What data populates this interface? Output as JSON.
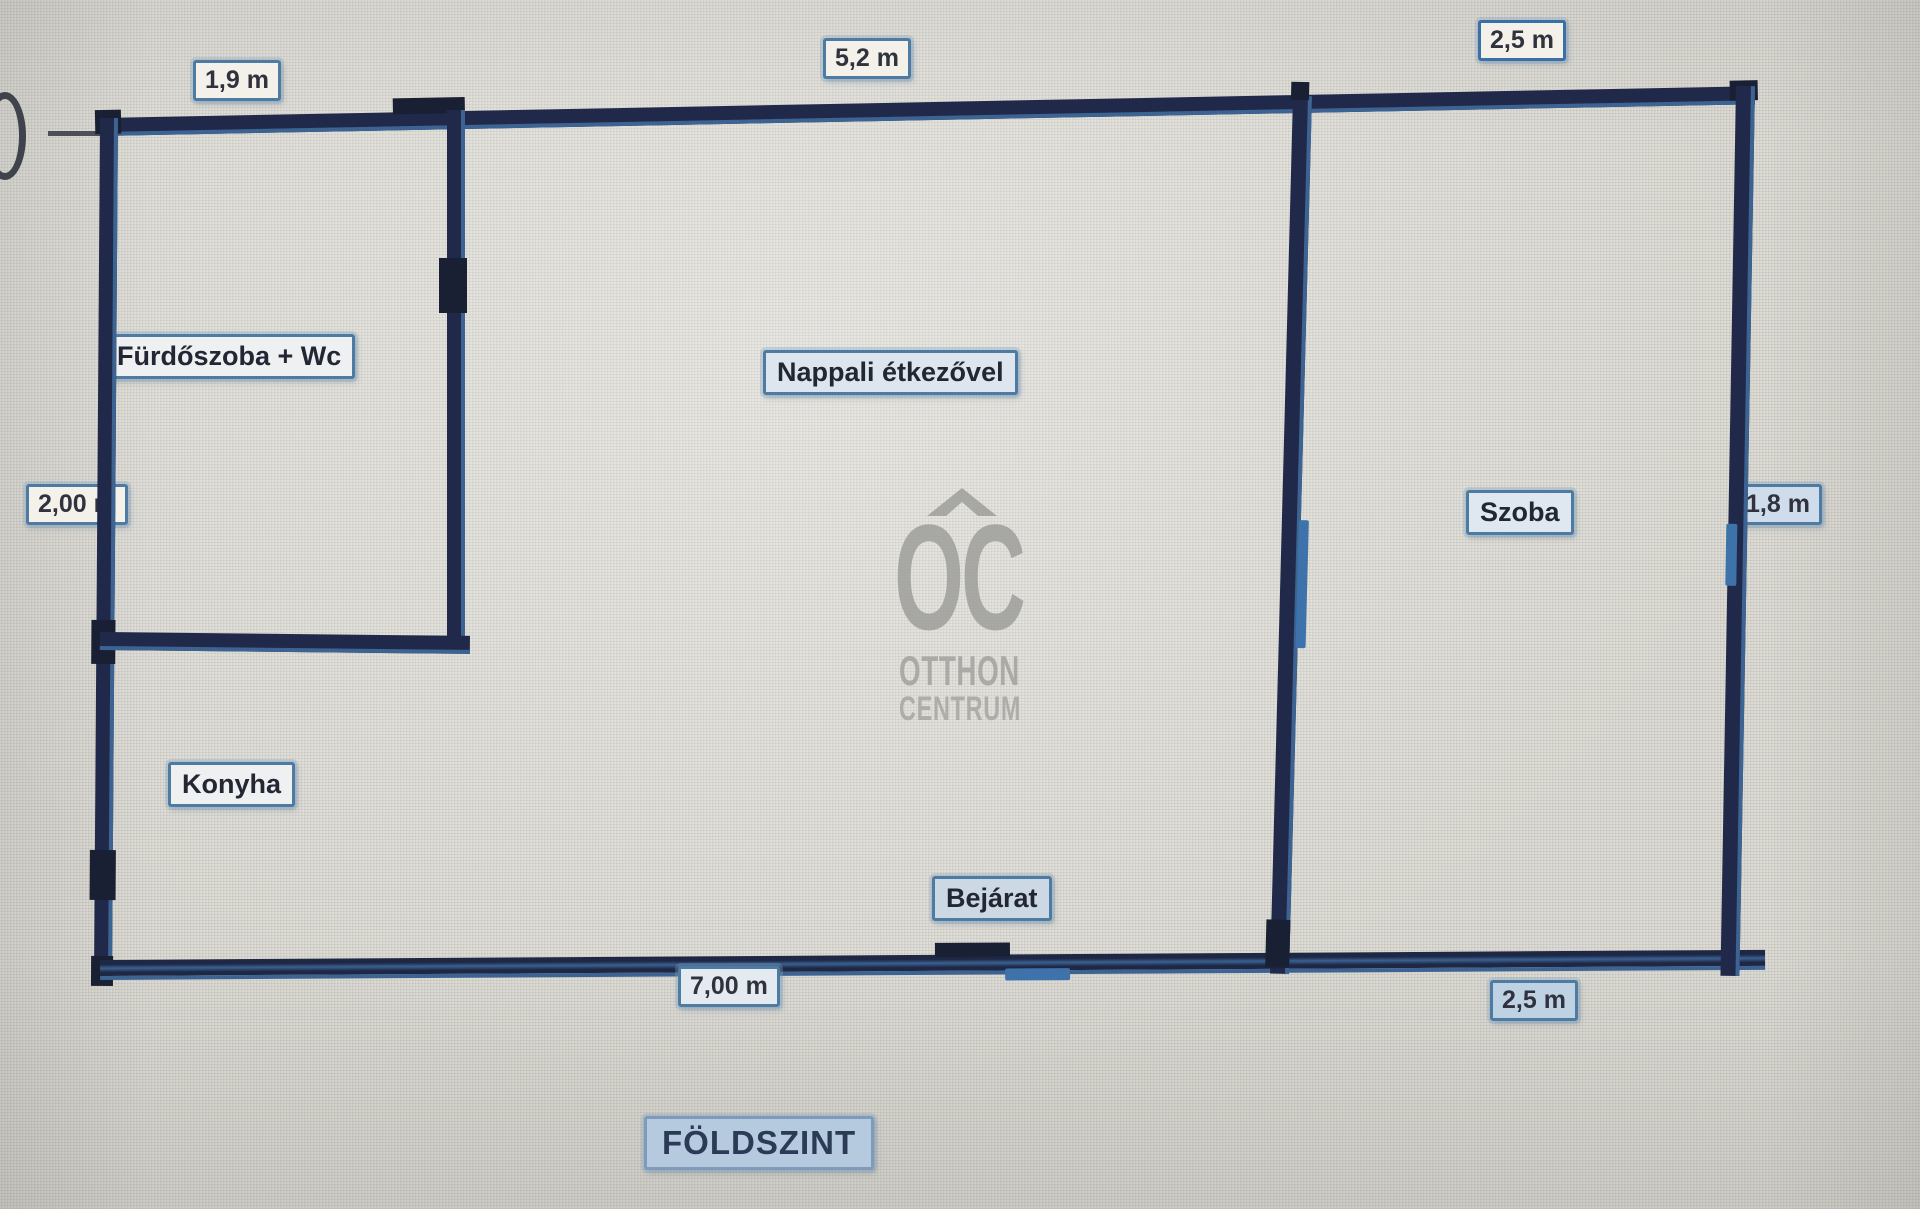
{
  "floor": {
    "title": "FÖLDSZINT"
  },
  "watermark": {
    "initials": "OC",
    "line1": "OTTHON",
    "line2": "CENTRUM"
  },
  "rooms": {
    "bathroom": "Fürdőszoba + Wc",
    "living": "Nappali étkezővel",
    "room": "Szoba",
    "kitchen": "Konyha",
    "entrance": "Bejárat"
  },
  "dimensions": {
    "top_left": "1,9 m",
    "top_middle": "5,2 m",
    "top_right": "2,5 m",
    "left": "2,00 m",
    "right": "1,8 m",
    "bottom_middle": "7,00 m",
    "bottom_right": "2,5 m"
  },
  "colors": {
    "wall": "#20294a",
    "wall_edge": "#3c6391",
    "door_mark": "#3e72aa",
    "label_border": "#4e7ba2",
    "label_bg": "#f3f1ea",
    "blue_label_bg": "#b5cade",
    "background": "#d8d6cf",
    "watermark_gray": "#9c9c99"
  }
}
